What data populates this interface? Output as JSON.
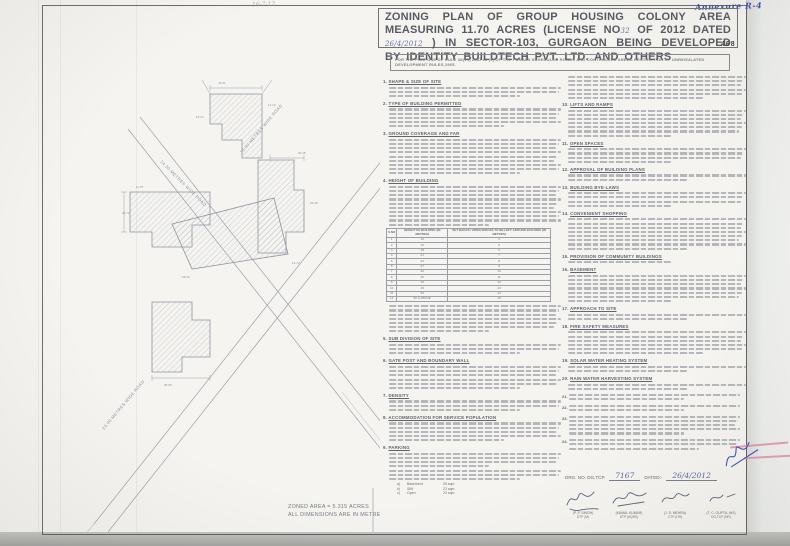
{
  "scan": {
    "stamp_number": "468",
    "handwritten_top_right": "Annexure R-4",
    "handwritten_top_center": "16-7-12",
    "ink_color": "#4553a6",
    "pink_mark_color": "#e08ea8"
  },
  "title_block": {
    "text_before_license": "ZONING PLAN OF GROUP HOUSING COLONY AREA MEASURING 11.70 ACRES (LICENSE NO",
    "license_no_handwritten": "32",
    "text_mid": "OF 2012 DATED",
    "license_date_handwritten": "26/4/2012",
    "text_after": ") IN SECTOR-103, GURGAON BEING DEVELOPED BY IDENTITY BUILDTECH PVT. LTD. AND OTHERS"
  },
  "purpose_note": "FOR THE PURPOSE OF RULE 38(vii) AND 48 (2) OF THE PUNJAB SCHEDULED ROADS AND CONTROLLED AREAS RESTRICTION OF UNREGULATED DEVELOPMENT RULES,1965.",
  "drawing": {
    "road_label_nw": "24.00 METRES WIDE ROAD",
    "road_label_ne": "75.00 METRES WIDE ROAD",
    "road_label_sw": "24.00 METRES WIDE ROAD",
    "zoned_area": "ZONED AREA = 5.315 ACRES",
    "dimensions_note": "ALL DIMENSIONS ARE IN METRES",
    "dimensions": [
      "43.81",
      "12.19",
      "15.24",
      "30.48",
      "24.38",
      "10.67",
      "45.72",
      "18.29",
      "13.72",
      "35.05"
    ]
  },
  "left_column": {
    "sections": [
      {
        "no": "1.",
        "heading": "SHAPE & SIZE OF SITE",
        "lines": 3
      },
      {
        "no": "2.",
        "heading": "TYPE OF BUILDING PERMITTED",
        "lines": 5
      },
      {
        "no": "3.",
        "heading": "GROUND COVERAGE AND FAR",
        "lines": 9
      },
      {
        "no": "4.",
        "heading": "HEIGHT OF BUILDING",
        "lines": 10,
        "table": true,
        "lines_after": 7
      },
      {
        "no": "5.",
        "heading": "SUB DIVISION OF SITE",
        "lines": 3
      },
      {
        "no": "6.",
        "heading": "GATE POST AND BOUNDARY WALL",
        "lines": 6
      },
      {
        "no": "7.",
        "heading": "DENSITY",
        "lines": 3
      },
      {
        "no": "8.",
        "heading": "ACCOMMODATION FOR SERVICE POPULATION",
        "lines": 5
      },
      {
        "no": "9.",
        "heading": "PARKING",
        "lines": 4,
        "list": true,
        "lines_after": 3
      }
    ]
  },
  "height_table": {
    "headers": [
      "S.NO",
      "HEIGHT OF BUILDING (IN METRES)",
      "SET BACKS / OPEN SPACES TO BE LEFT AROUND BUILDING (IN METRES)"
    ],
    "rows": [
      [
        "1",
        "10",
        "3"
      ],
      [
        "2",
        "15",
        "5"
      ],
      [
        "3",
        "18",
        "6"
      ],
      [
        "4",
        "21",
        "7"
      ],
      [
        "5",
        "24",
        "8"
      ],
      [
        "6",
        "27",
        "9"
      ],
      [
        "7",
        "30",
        "10"
      ],
      [
        "8",
        "35",
        "11"
      ],
      [
        "9",
        "40",
        "12"
      ],
      [
        "10",
        "45",
        "13"
      ],
      [
        "11",
        "50",
        "14"
      ],
      [
        "12",
        "50 & ABOVE",
        "15"
      ]
    ]
  },
  "parking_list": [
    {
      "key": "a)",
      "label": "Basement",
      "value": "25 sqm"
    },
    {
      "key": "b)",
      "label": "Stilt",
      "value": "23 sqm"
    },
    {
      "key": "c)",
      "label": "Open",
      "value": "23 sqm"
    }
  ],
  "right_column": {
    "intro_lines": 6,
    "sections": [
      {
        "no": "10.",
        "heading": "LIFTS AND RAMPS",
        "lines": 7
      },
      {
        "no": "11.",
        "heading": "OPEN SPACES",
        "lines": 4
      },
      {
        "no": "12.",
        "heading": "APPROVAL OF BUILDING PLANS",
        "lines": 2
      },
      {
        "no": "13.",
        "heading": "BUILDING BYE-LAWS",
        "lines": 4
      },
      {
        "no": "14.",
        "heading": "CONVENIENT SHOPPING",
        "lines": 8
      },
      {
        "no": "15.",
        "heading": "PROVISION OF COMMUNITY BUILDINGS",
        "lines": 1
      },
      {
        "no": "16.",
        "heading": "BASEMENT",
        "lines": 7
      },
      {
        "no": "17.",
        "heading": "APPROACH TO SITE",
        "lines": 2
      },
      {
        "no": "18.",
        "heading": "FIRE SAFETY MEASURES",
        "lines": 6
      },
      {
        "no": "19.",
        "heading": "SOLAR WATER HEATING SYSTEM",
        "lines": 2
      },
      {
        "no": "20.",
        "heading": "RAIN WATER HARVESTING SYSTEM",
        "lines": 2
      }
    ],
    "notes": [
      {
        "no": "21.",
        "lines": 2
      },
      {
        "no": "22.",
        "lines": 2
      },
      {
        "no": "23.",
        "lines": 5
      },
      {
        "no": "24.",
        "lines": 3
      }
    ]
  },
  "footer": {
    "drg_label": "DRG. NO. DG,TCP.",
    "drg_no": "7167",
    "dated_label": "DATED:-",
    "dated_value": "26/4/2012",
    "signatures": [
      {
        "name": "(P. P. SINGH)",
        "title": "DTP (M)"
      },
      {
        "name": "(KAMAL KUMAR)",
        "title": "DTP (HQRS)"
      },
      {
        "name": "(J. S. MEHRA)",
        "title": "CTP (HR)"
      },
      {
        "name": "(T. C. GUPTA, IAS)",
        "title": "DG,TCP (HR)"
      }
    ]
  }
}
